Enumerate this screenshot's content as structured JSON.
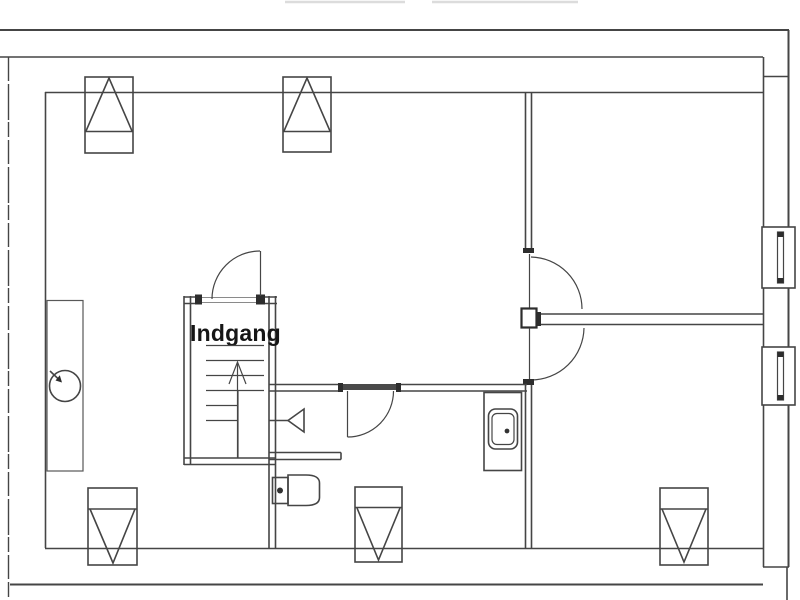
{
  "floor_plan": {
    "entrance_label": "Indgang",
    "colors": {
      "background": "#ffffff",
      "line": "#454545",
      "line_dark": "#2d2d2d",
      "line_faint": "#dcdcdc",
      "text": "#161616"
    },
    "symbols": {
      "stairs": "stairs-up-arrow",
      "skylights_top_count": 2,
      "skylights_bottom_count": 3,
      "right_wall_windows_count": 2,
      "doors": [
        "entrance-door",
        "upper-room-door",
        "lower-room-door",
        "bathroom-door"
      ],
      "bathroom_fixtures": [
        "toilet-icon",
        "washbasin-icon",
        "shower-tray-icon"
      ],
      "kitchen_fixtures": [
        "sink-icon"
      ]
    }
  }
}
